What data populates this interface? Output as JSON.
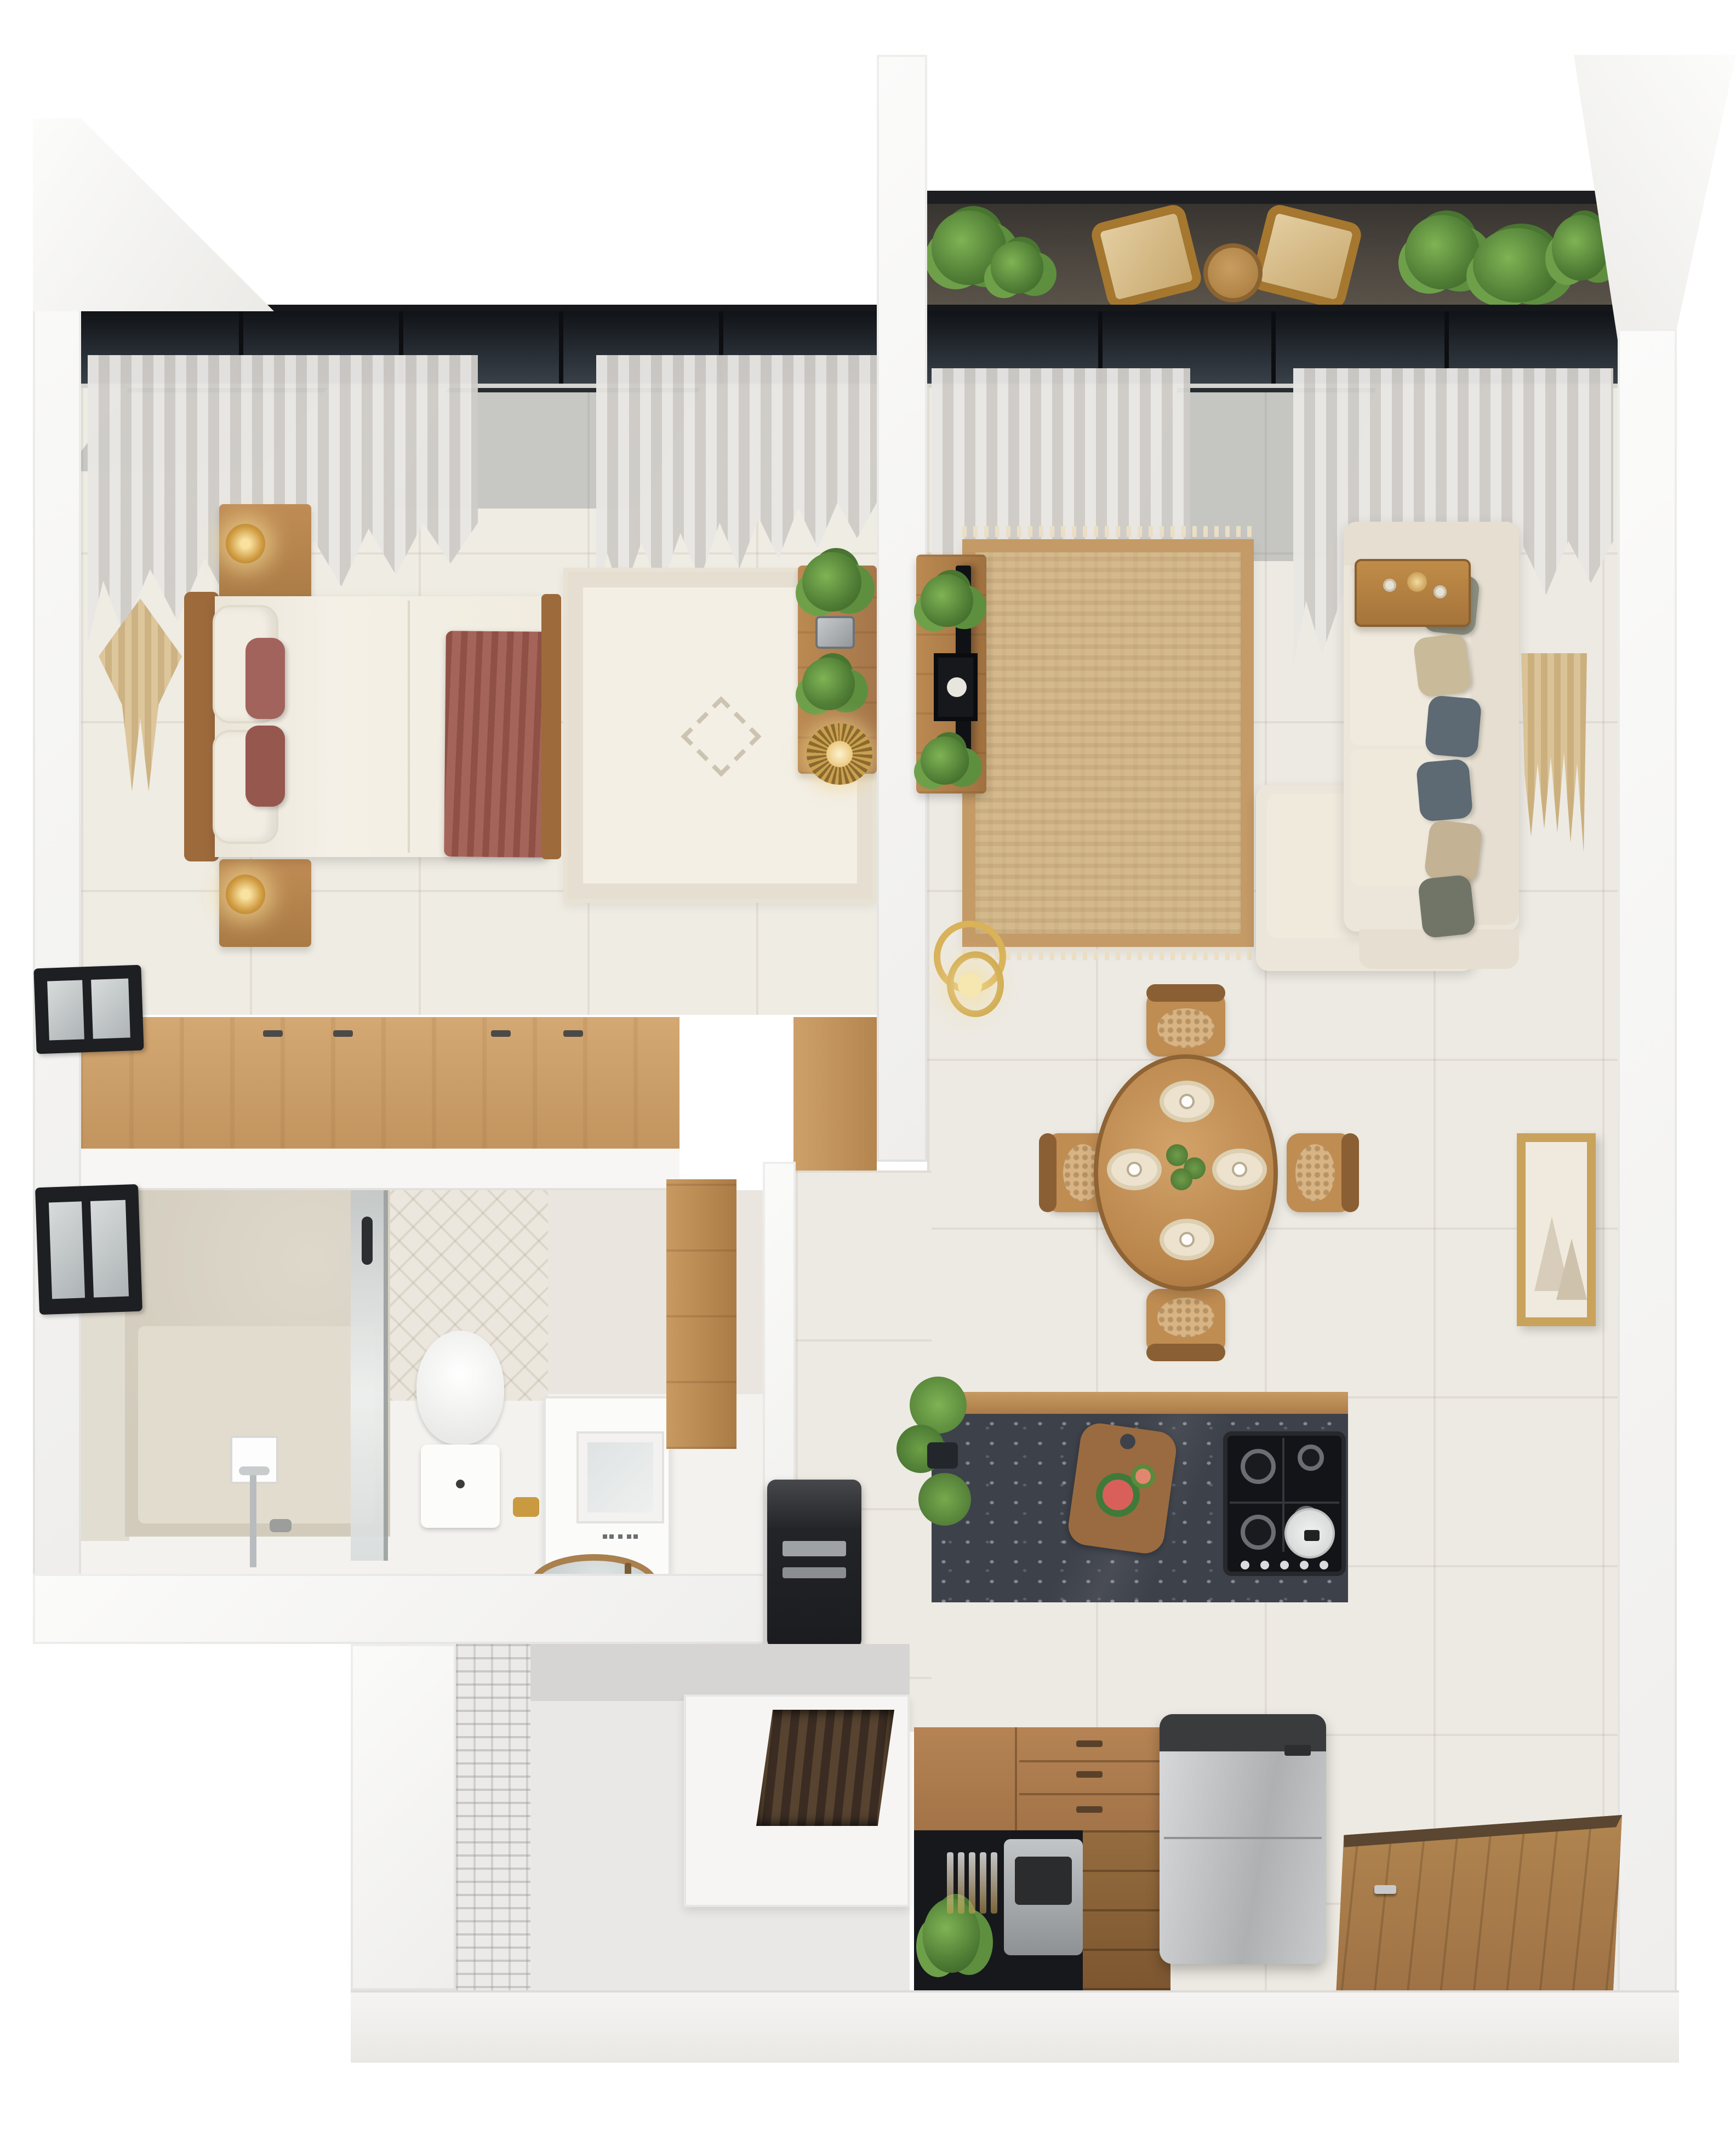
{
  "title": "3D rendered one-bedroom apartment floor plan",
  "colors": {
    "floor": "#edeae3",
    "wall": "#f6f5f3",
    "wood": "#c0905c",
    "wood-deep": "#a5764a",
    "marble": "#3d414a",
    "sofa": "#ece6da",
    "jute": "#d4b98c",
    "terracotta": "#9c5b51",
    "curtain": "#dcd9d5",
    "green": "#5f8f3e",
    "gold": "#c9973f",
    "fridge": "#c6c8ca",
    "dark-glazing": "#20242a"
  },
  "rooms": [
    {
      "name": "bedroom",
      "items": [
        "double-bed",
        "wood-headboard",
        "white-duvet",
        "terracotta-throw",
        "accent-pillows",
        "nightstand-upper",
        "nightstand-lower",
        "brass-table-lamp-upper",
        "brass-table-lamp-lower",
        "macrame-wall-hanging",
        "berber-area-rug",
        "wall-desk",
        "desk-plants",
        "sunburst-lamp",
        "sheer-curtains",
        "floor-to-ceiling-glazing",
        "built-in-wardrobe"
      ]
    },
    {
      "name": "living-room",
      "items": [
        "sectional-sofa",
        "chaise-lounge",
        "scatter-pillows",
        "jute-rug",
        "tv-console",
        "tv",
        "leaning-art-print",
        "console-plants",
        "wood-side-table",
        "macrame-wall-hanging",
        "gold-ring-lamp",
        "sheer-curtains",
        "sliding-glass-door"
      ]
    },
    {
      "name": "balcony",
      "items": [
        "outdoor-chair-left",
        "outdoor-chair-right",
        "bistro-table",
        "potted-palms",
        "dark-decking"
      ]
    },
    {
      "name": "dining-area",
      "items": [
        "round-dining-table",
        "dining-chair-north",
        "dining-chair-south",
        "dining-chair-west",
        "dining-chair-east",
        "round-placemats",
        "coffee-cups",
        "centerpiece-plant",
        "framed-botanical-art"
      ]
    },
    {
      "name": "kitchen",
      "items": [
        "island-black-marble-top",
        "island-wood-base",
        "gas-hob",
        "frying-pan",
        "cutting-board-with-watermelon",
        "potted-herb",
        "coffee-machine",
        "wicker-baskets",
        "drawer-cabinet",
        "bar-cabinet-with-bottles",
        "built-in-appliance",
        "refrigerator"
      ]
    },
    {
      "name": "bathroom",
      "items": [
        "walk-in-shower",
        "stone-feature-wall",
        "glass-screen",
        "shower-set",
        "toilet",
        "gold-paper-holder",
        "vanity-unit",
        "mirror",
        "vessel-basin",
        "tall-wood-cabinet",
        "window-upper",
        "window-lower",
        "patterned-tile-wall"
      ]
    },
    {
      "name": "entry",
      "items": [
        "wood-entry-floor",
        "front-door",
        "door-handle"
      ]
    },
    {
      "name": "stairwell",
      "items": [
        "stair-flight",
        "breeze-block-wall",
        "landing"
      ]
    }
  ]
}
